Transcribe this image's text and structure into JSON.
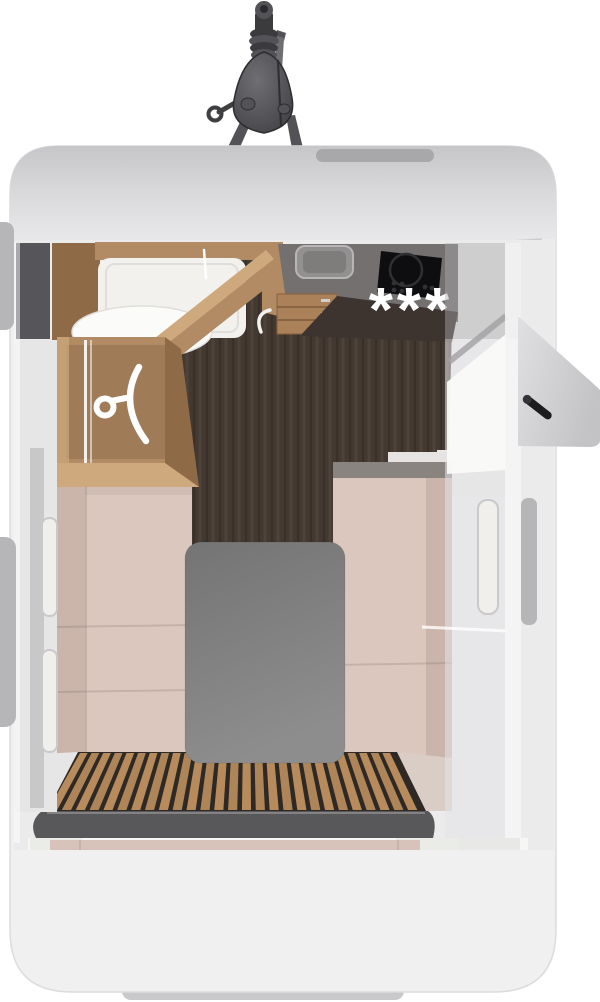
{
  "scene": {
    "type": "caravan-floorplan-top-view",
    "description": "Bird's-eye 3D rendering of a compact caravan: tow hitch at the front, washroom and wardrobe front-left, kitchenette front-right, open entry door on the right side, lounge benches with a centre table, slatted rear deck.",
    "kitchen": {
      "fridge_rating_symbol": "***",
      "appliances": [
        "sink",
        "hob",
        "drawer-unit",
        "fridge"
      ]
    },
    "wardrobe": {
      "icon": "hanger-icon"
    },
    "bathroom": {
      "fixtures": [
        "shower-tray",
        "toilet"
      ]
    },
    "entry_door": {
      "state": "open",
      "side": "right"
    },
    "rear_deck": {
      "slat_count": 27
    },
    "windows": {
      "left_wall": 2,
      "right_wall": 1
    }
  },
  "colors": {
    "bg": "#ffffff",
    "body": "#f0f0f1",
    "bodyEdge": "#dcdcde",
    "capTop": "#c6c6c8",
    "capMid": "#d9d9db",
    "capBot": "#ebebed",
    "vent": "#a8a8ab",
    "hitchDark": "#3b3b3e",
    "hitchMid": "#525257",
    "hitchLight": "#6e6e73",
    "cabinet": "#55555a",
    "wood": "#b28a63",
    "woodDark": "#8f6a47",
    "woodLight": "#cfa97e",
    "floor": "#443931",
    "plank": "#2f2822",
    "counter": "#747070",
    "counterFront": "#3d3430",
    "sink": "#929090",
    "sinkInner": "#7f7d7b",
    "hob": "#0e0e10",
    "hobRing": "#303032",
    "drawer": "#aa8159",
    "drawerLine": "#7c5a3a",
    "star": "#ffffff",
    "seat": "#dbc7bd",
    "seatDark": "#cbb5aa",
    "trimDark": "#8a8480",
    "shelf": "#e6e4e2",
    "tableA": "#747474",
    "tableB": "#8d8d8d",
    "slat": "#b78b5c",
    "slatBase": "#2e2925",
    "step": "#58585a",
    "board": "#d8c3ba",
    "recessA": "#cdb9b0",
    "recessB": "#b19e95",
    "sill": "#e3e4e0",
    "rearSeam": "#6f6a66",
    "wall": "#e6e6e7",
    "frame": "#aaaaac",
    "windowSlot": "#f0efec",
    "windowFrame": "#c9c9cb",
    "tab": "#b6b6b8",
    "flapA": "#e0e0e2",
    "flapB": "#c3c3c5",
    "handleDark": "#1c1c1e",
    "tray": "#f2f1ee",
    "toilet": "#fbfbf9",
    "white": "#f6f6f5",
    "deckSide": "#d9cdc6",
    "pillar": "#eaece8",
    "bumper": "#c9c9cb"
  }
}
